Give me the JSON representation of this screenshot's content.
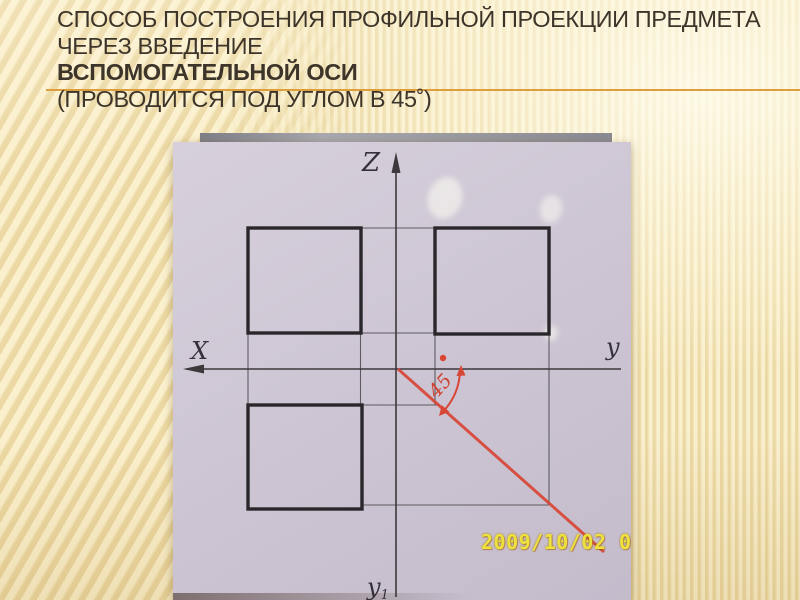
{
  "title": {
    "lines": [
      "СПОСОБ ПОСТРОЕНИЯ ПРОФИЛЬНОЙ ПРОЕКЦИИ ПРЕДМЕТА",
      "ЧЕРЕЗ ВВЕДЕНИЕ",
      "ВСПОМОГАТЕЛЬНОЙ ОСИ",
      "(ПРОВОДИТСЯ ПОД УГЛОМ В 45˚)"
    ]
  },
  "photo": {
    "timestamp": "2009/10/02 00",
    "labels": {
      "z_axis": "Z",
      "x_axis": "X",
      "y_axis": "y",
      "y1_axis": "y",
      "y1_sub": "1",
      "angle": "45"
    }
  },
  "diagram": {
    "type": "orthographic-projection-sketch",
    "axes": [
      "Z",
      "X",
      "y",
      "y1"
    ],
    "square_views": 3,
    "auxiliary_axis_angle_deg": 45
  },
  "colors": {
    "background_base": "#F5E7BC",
    "title_text": "#3D342A",
    "accent_rule": "#DD9E3E",
    "paper": "#CDC5D3",
    "pencil_thick": "#2A272B",
    "pencil_thin": "#5F5A60",
    "red_line": "#D84636",
    "timestamp_yellow": "#EDE23B"
  }
}
